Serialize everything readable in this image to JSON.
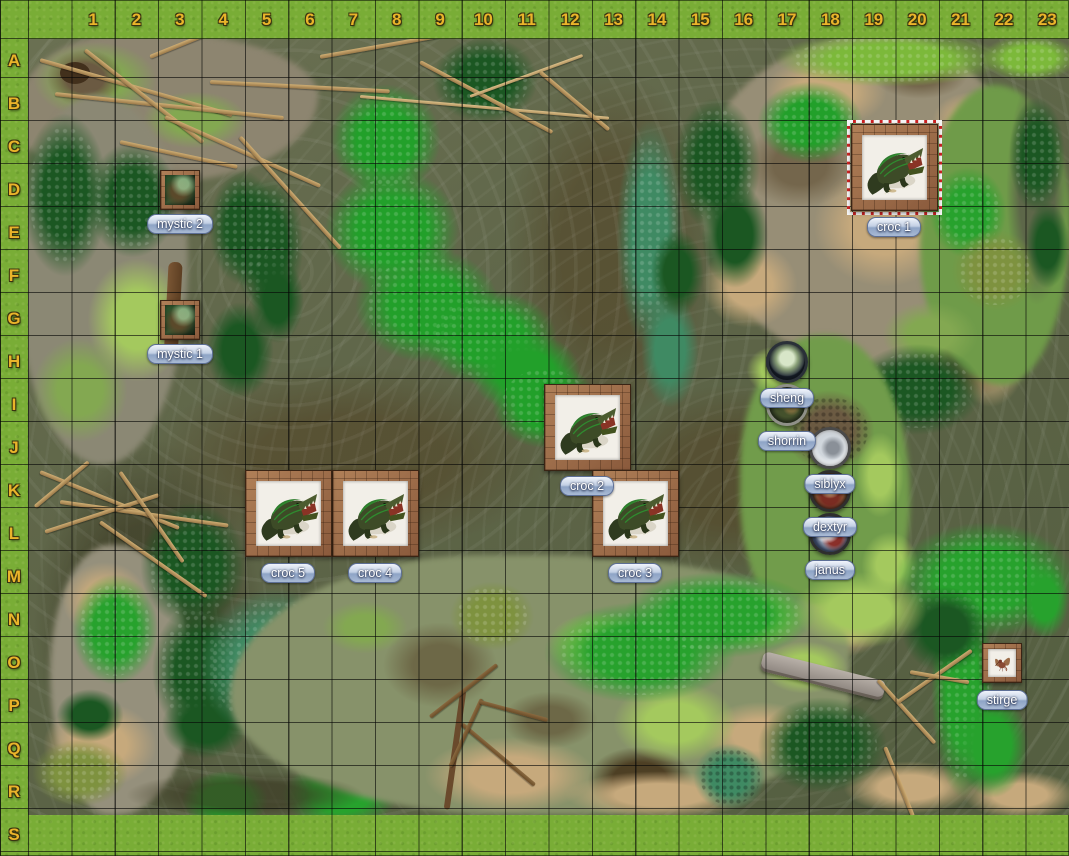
{
  "map": {
    "grid": {
      "columns": [
        "1",
        "2",
        "3",
        "4",
        "5",
        "6",
        "7",
        "8",
        "9",
        "10",
        "11",
        "12",
        "13",
        "14",
        "15",
        "16",
        "17",
        "18",
        "19",
        "20",
        "21",
        "22",
        "23"
      ],
      "rows": [
        "A",
        "B",
        "C",
        "D",
        "E",
        "F",
        "G",
        "H",
        "I",
        "J",
        "K",
        "L",
        "M",
        "N",
        "O",
        "P",
        "Q",
        "R",
        "S"
      ]
    },
    "terrain_theme": "swamp"
  },
  "tokens": [
    {
      "id": "mystic-2",
      "label": "mystic 2",
      "cell": "D3",
      "size": "1x1",
      "shape": "square-framed",
      "selected": false
    },
    {
      "id": "mystic-1",
      "label": "mystic 1",
      "cell": "G3",
      "size": "1x1",
      "shape": "square-framed",
      "selected": false
    },
    {
      "id": "croc-1",
      "label": "croc 1",
      "cell": "C19-D20",
      "size": "2x2",
      "shape": "square-framed",
      "selected": true
    },
    {
      "id": "croc-2",
      "label": "croc 2",
      "cell": "I12-J13",
      "size": "2x2",
      "shape": "square-framed",
      "selected": false
    },
    {
      "id": "croc-3",
      "label": "croc 3",
      "cell": "K13-L14",
      "size": "2x2",
      "shape": "square-framed",
      "selected": false
    },
    {
      "id": "croc-4",
      "label": "croc 4",
      "cell": "K7-L8",
      "size": "2x2",
      "shape": "square-framed",
      "selected": false
    },
    {
      "id": "croc-5",
      "label": "croc 5",
      "cell": "K5-L6",
      "size": "2x2",
      "shape": "square-framed",
      "selected": false
    },
    {
      "id": "sheng",
      "label": "sheng",
      "cell": "H17",
      "size": "1x1",
      "shape": "round",
      "selected": false
    },
    {
      "id": "shorrin",
      "label": "shorrin",
      "cell": "I17",
      "size": "1x1",
      "shape": "round",
      "selected": false
    },
    {
      "id": "siblyx",
      "label": "siblyx",
      "cell": "J18",
      "size": "1x1",
      "shape": "round",
      "selected": false
    },
    {
      "id": "dextyr",
      "label": "dextyr",
      "cell": "K18",
      "size": "1x1",
      "shape": "round",
      "selected": false
    },
    {
      "id": "janus",
      "label": "janus",
      "cell": "L18",
      "size": "1x1",
      "shape": "round",
      "selected": false
    },
    {
      "id": "stirge",
      "label": "stirge",
      "cell": "O22",
      "size": "1x1",
      "shape": "square-framed",
      "selected": false
    }
  ],
  "colors": {
    "header_text": "#eab42a",
    "label_pill_top": "#f0f4fb",
    "label_pill_bottom": "#a9bad4",
    "label_pill_border": "#5d6f96",
    "label_text": "#ffffff",
    "selection_red": "#cc2222",
    "selection_white": "#f5f5f5",
    "grid_line": "#101010",
    "lawn_green": "#79ad36",
    "swamp_water": "#5e6548",
    "token_frame_brown": "#96684a"
  }
}
